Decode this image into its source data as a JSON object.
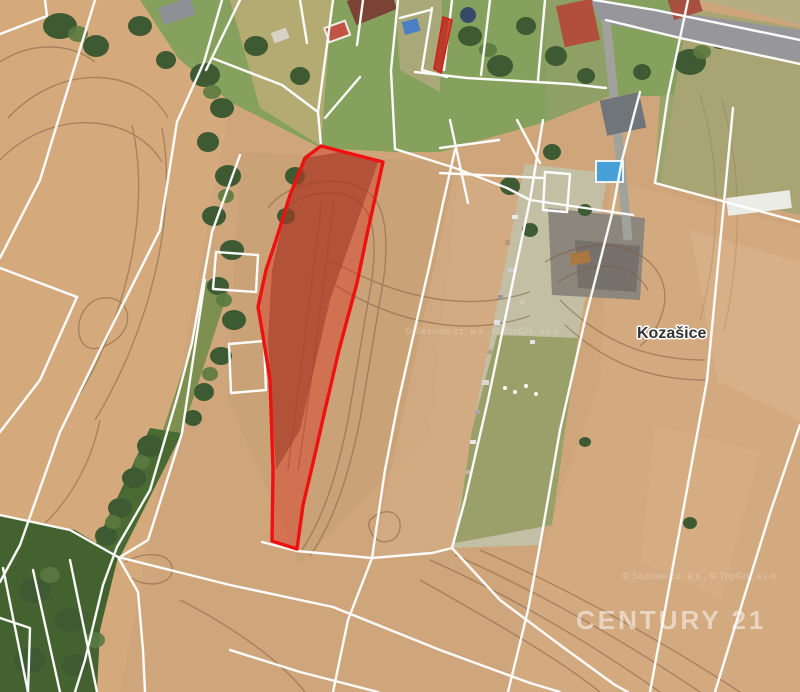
{
  "map": {
    "place_label": "Kozašice",
    "brand_watermark": "CENTURY 21",
    "attribution": "© Seznam.cz, a.s., © TopGis, s.r.o.",
    "colors": {
      "field_base": "#cfa67b",
      "field_light": "#dcb68d",
      "field_olive": "#a8a474",
      "strip_pale": "#c3bfa4",
      "strip_olive": "#9aa069",
      "garden_green": "#87a05e",
      "tree_green": "#3e5a33",
      "cadastral_line": "#ffffff",
      "highlight_fill": "#d92d20",
      "highlight_stroke": "#ee1111",
      "road_gray": "#97979b",
      "pool_blue": "#48a0d8",
      "roof_red": "#b14e3c",
      "roof_gray": "#70757a",
      "label_text": "#333333",
      "watermark_white": "#ffffff"
    }
  }
}
